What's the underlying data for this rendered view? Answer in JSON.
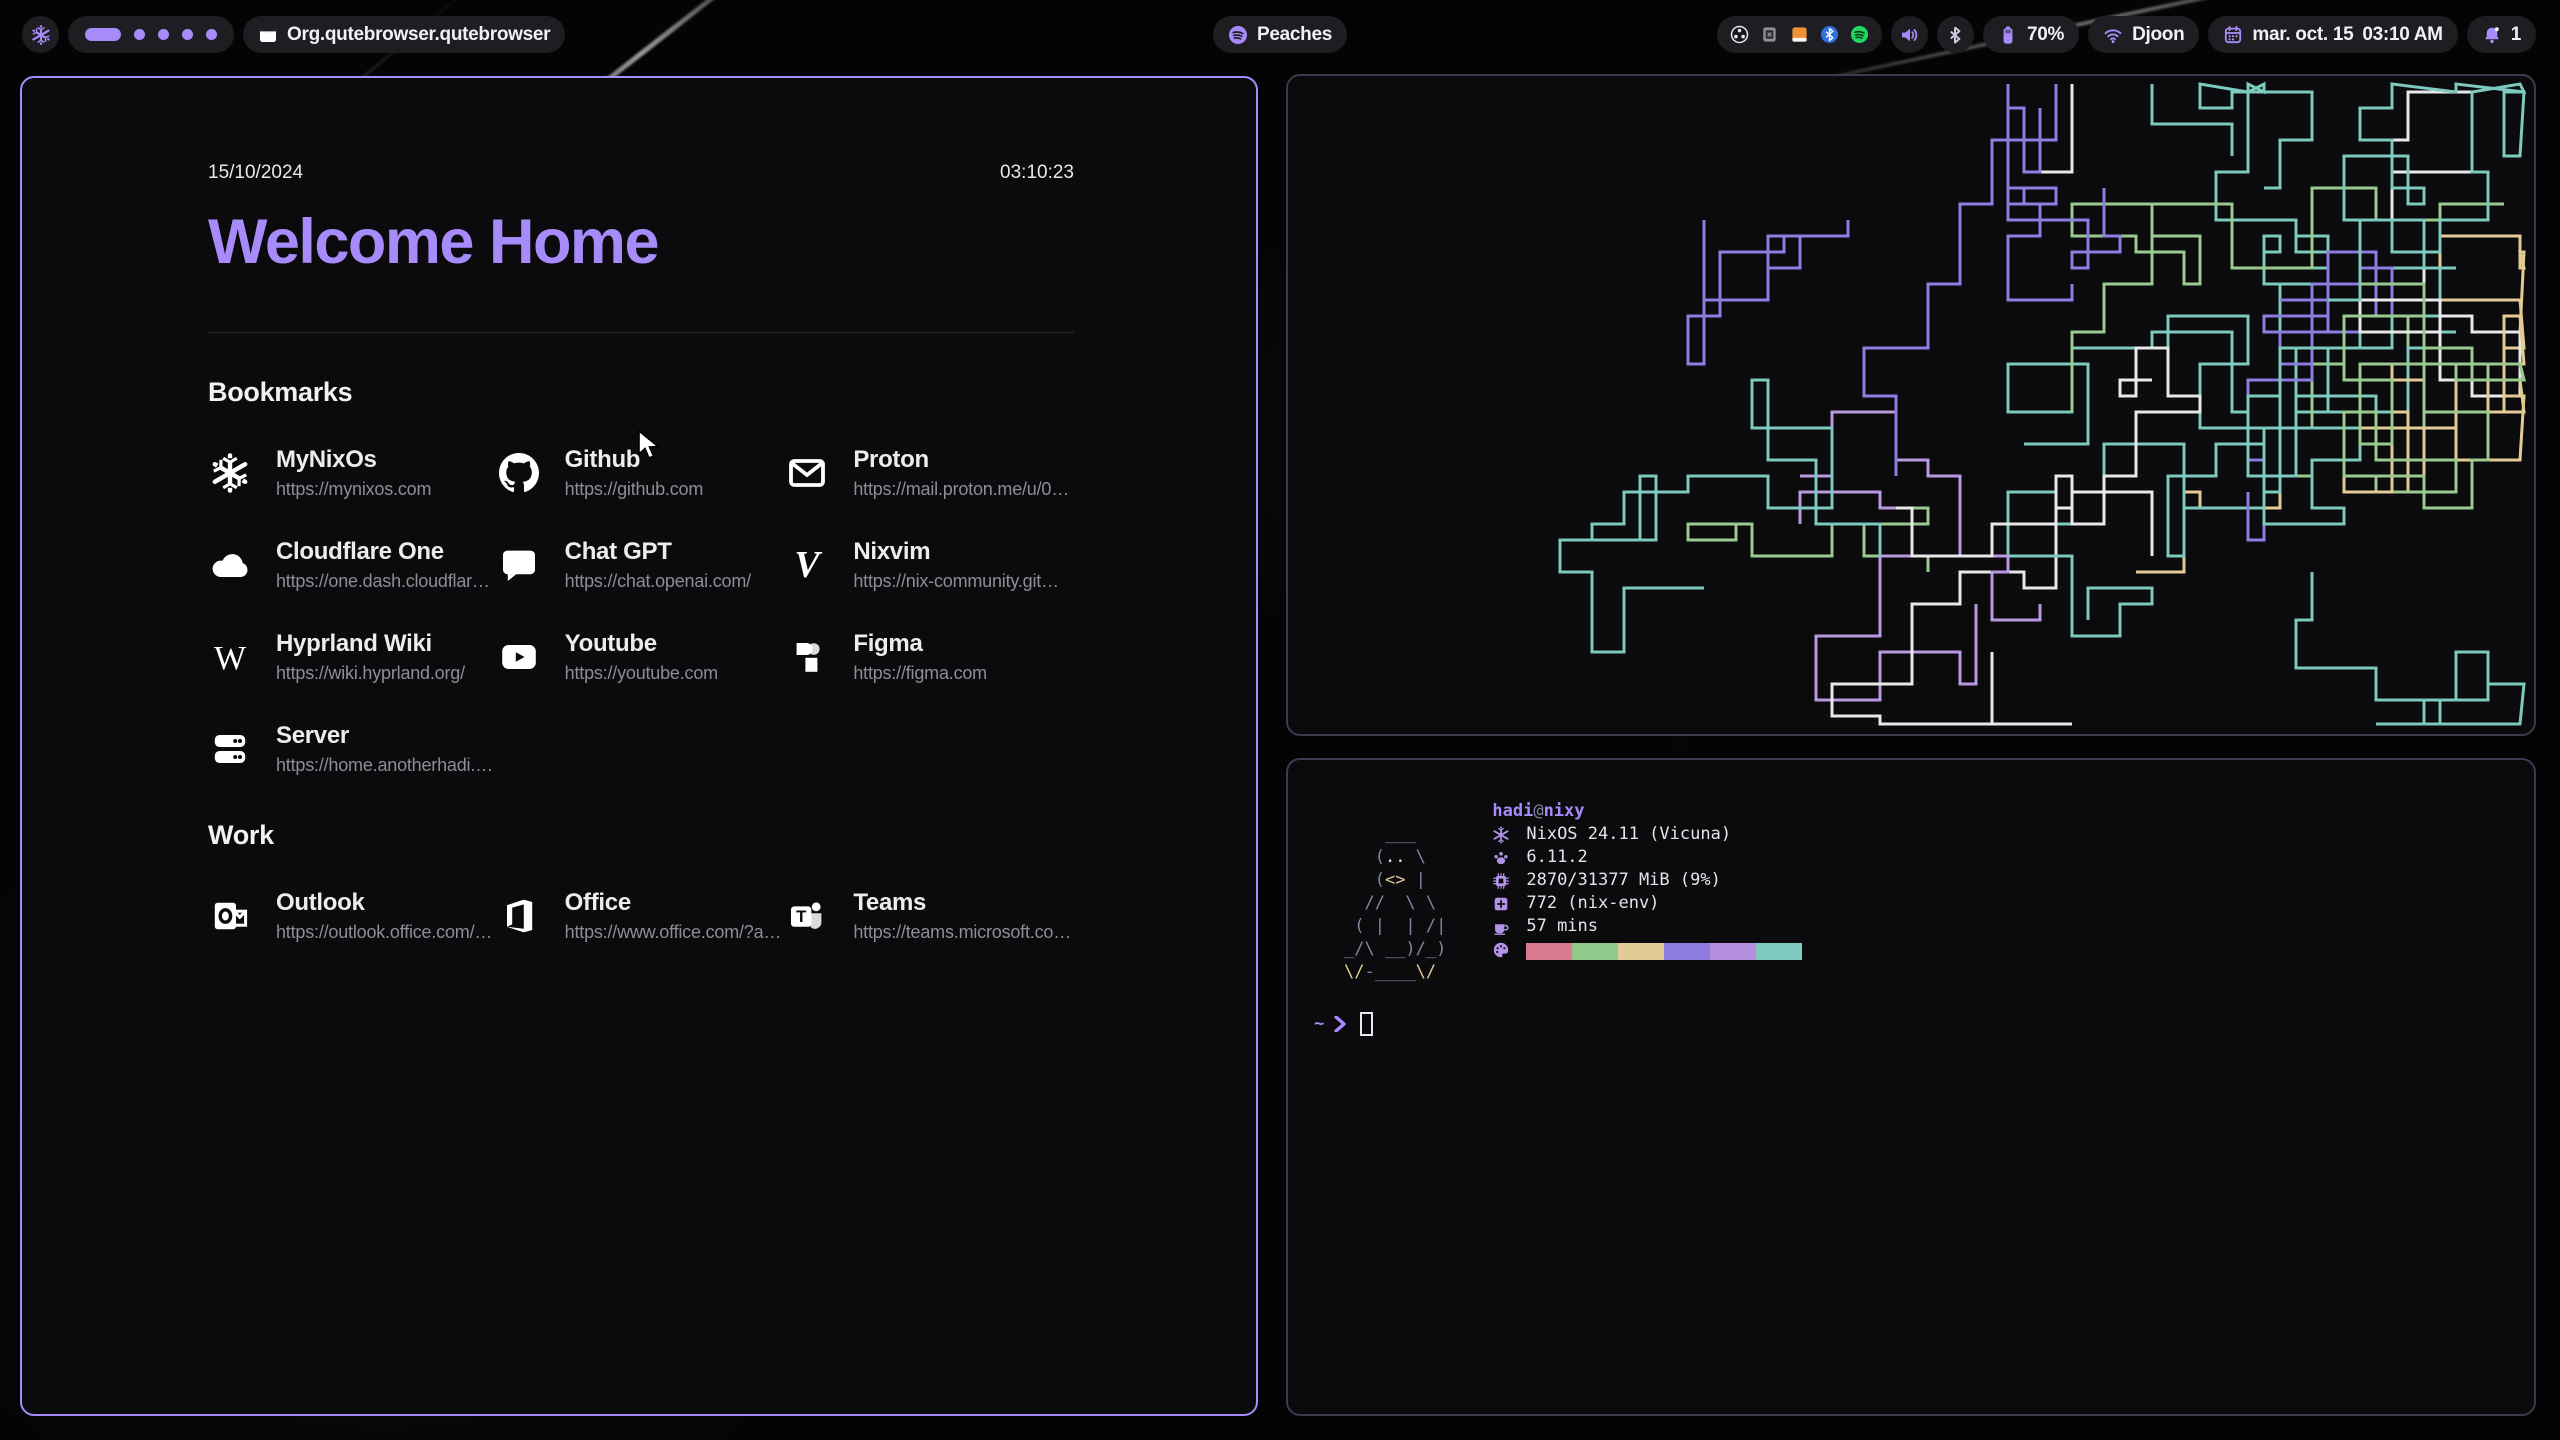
{
  "colors": {
    "accent": "#a78bfa",
    "pill_bg": "#1e1e22",
    "window_bg": "#0b0b0d",
    "inactive_border": "#3b3b4e"
  },
  "bar": {
    "workspaces": {
      "count": 5,
      "active_index": 0
    },
    "window_title": "Org.qutebrowser.qutebrowser",
    "media": {
      "label": "Peaches",
      "icon": "spotify-icon"
    },
    "tray_icons": [
      "obs-icon",
      "box-icon",
      "downloads-icon",
      "bluetooth-badge-icon",
      "spotify-green-icon"
    ],
    "battery": "70%",
    "network_ssid": "Djoon",
    "clock_date": "mar. oct. 15",
    "clock_time": "03:10 AM",
    "notification_count": "1"
  },
  "startpage": {
    "date": "15/10/2024",
    "time": "03:10:23",
    "title": "Welcome Home",
    "sections": [
      {
        "label": "Bookmarks",
        "items": [
          {
            "name": "MyNixOs",
            "url": "https://mynixos.com",
            "icon": "nix-icon"
          },
          {
            "name": "Github",
            "url": "https://github.com",
            "icon": "github-icon"
          },
          {
            "name": "Proton",
            "url": "https://mail.proton.me/u/0…",
            "icon": "mail-icon"
          },
          {
            "name": "Cloudflare One",
            "url": "https://one.dash.cloudflar…",
            "icon": "cloud-icon"
          },
          {
            "name": "Chat GPT",
            "url": "https://chat.openai.com/",
            "icon": "chat-icon"
          },
          {
            "name": "Nixvim",
            "url": "https://nix-community.git…",
            "icon": "nixvim-icon"
          },
          {
            "name": "Hyprland Wiki",
            "url": "https://wiki.hyprland.org/",
            "icon": "wiki-icon"
          },
          {
            "name": "Youtube",
            "url": "https://youtube.com",
            "icon": "youtube-icon"
          },
          {
            "name": "Figma",
            "url": "https://figma.com",
            "icon": "figma-icon"
          },
          {
            "name": "Server",
            "url": "https://home.anotherhadi.…",
            "icon": "server-icon"
          }
        ]
      },
      {
        "label": "Work",
        "items": [
          {
            "name": "Outlook",
            "url": "https://outlook.office.com/…",
            "icon": "outlook-icon"
          },
          {
            "name": "Office",
            "url": "https://www.office.com/?a…",
            "icon": "office-icon"
          },
          {
            "name": "Teams",
            "url": "https://teams.microsoft.co…",
            "icon": "teams-icon"
          }
        ]
      }
    ]
  },
  "pipes_terminal": {
    "palette": [
      "#7cc9bd",
      "#8b7de0",
      "#e8e8e8",
      "#7cc9bd",
      "#9ac98f",
      "#b79ae0",
      "#7cc9bd",
      "#e8e8e8",
      "#8b7de0",
      "#e3cb95",
      "#7cc9bd",
      "#9ac98f"
    ]
  },
  "fetch_terminal": {
    "user": "hadi",
    "at": "@",
    "host": "nixy",
    "ascii_art": [
      [
        [
          "    ___",
          "c-gray"
        ]
      ],
      [
        [
          "   (",
          "c-gray"
        ],
        [
          "..",
          "c-white"
        ],
        [
          " \\",
          "c-gray"
        ]
      ],
      [
        [
          "   (",
          "c-gray"
        ],
        [
          "<>",
          "c-yellow"
        ],
        [
          " |",
          "c-gray"
        ]
      ],
      [
        [
          "  //  \\ \\",
          "c-gray"
        ]
      ],
      [
        [
          " ( |  | /|",
          "c-gray"
        ]
      ],
      [
        [
          "_/\\ __)/_)",
          "c-gray"
        ]
      ],
      [
        [
          "\\/",
          "c-yellow"
        ],
        [
          "-____",
          "c-gray"
        ],
        [
          "\\/",
          "c-yellow"
        ]
      ]
    ],
    "info": [
      {
        "icon": "snowflake-icon",
        "text": "NixOS 24.11 (Vicuna)"
      },
      {
        "icon": "kernel-icon",
        "text": "6.11.2"
      },
      {
        "icon": "memory-icon",
        "text": "2870/31377 MiB (9%)"
      },
      {
        "icon": "packages-icon",
        "text": "772 (nix-env)"
      },
      {
        "icon": "uptime-icon",
        "text": "57 mins"
      }
    ],
    "palette": [
      "#d97b93",
      "#90c989",
      "#e3cb95",
      "#8d7be0",
      "#b48fdd",
      "#80c9c0"
    ],
    "prompt_cwd": "~"
  }
}
